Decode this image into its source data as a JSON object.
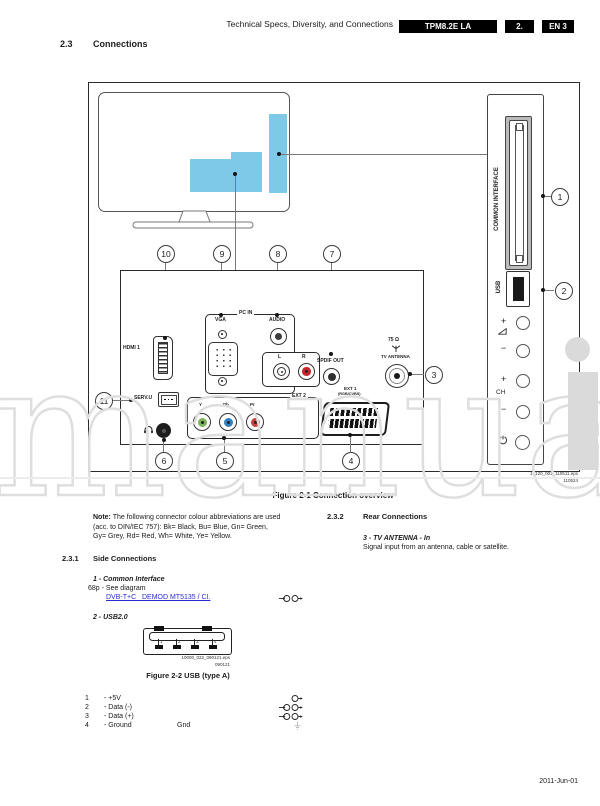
{
  "header": {
    "title": "Technical Specs, Diversity, and Connections",
    "badge_model": "TPM8.2E LA",
    "badge_chapter": "2.",
    "badge_page": "EN 3"
  },
  "section": {
    "number": "2.3",
    "title": "Connections"
  },
  "fig1": {
    "caption": "Figure 2-1 Connection overview",
    "eps_ref": "19120_001_110511.eps",
    "eps_date": "110524",
    "callouts": {
      "n1": "1",
      "n2": "2",
      "n3": "3",
      "n4": "4",
      "n5": "5",
      "n6": "6",
      "n7": "7",
      "n8": "8",
      "n9": "9",
      "n10": "10",
      "n11": "11"
    },
    "labels": {
      "common_interface": "COMMON INTERFACE",
      "usb": "USB",
      "hdmi": "HDMI 1",
      "pc_in": "PC IN",
      "vga": "VGA",
      "audio": "AUDIO",
      "left": "L",
      "right": "R",
      "spdif": "SPDIF OUT",
      "ohm": "75 Ω",
      "tv_antenna": "TV ANTENNA",
      "serv": "SERV.U",
      "ext2": "EXT 2",
      "y": "Y",
      "pb": "Pb",
      "pr": "Pr",
      "ext1": "EXT 1",
      "ext1_sub": "(RGB/CVBS)",
      "plus": "+",
      "minus": "−",
      "ch": "CH"
    }
  },
  "note": {
    "label": "Note:",
    "text1": " The following connector colour abbreviations are used",
    "text2": "(acc. to DIN/IEC 757): Bk= Black, Bu= Blue, Gn= Green,",
    "text3": "Gy= Grey, Rd= Red, Wh= White, Ye= Yellow."
  },
  "sec232": {
    "number": "2.3.2",
    "title": "Rear Connections",
    "item_title": "3 - TV ANTENNA - In",
    "item_text": "Signal input from an antenna, cable or satellite."
  },
  "sec231": {
    "number": "2.3.1",
    "title": "Side Connections",
    "item1_title": "1 - Common Interface",
    "item1_text": "68p - See diagram",
    "item1_link": "DVB-T+C_ DEMOD MT5135 / CI.",
    "item2_title": "2 - USB2.0"
  },
  "fig2": {
    "caption": "Figure 2-2  USB (type A)",
    "eps_ref": "10000_022_090121.eps",
    "eps_date": "090121",
    "pin_labels": [
      "1",
      "2",
      "3",
      "4"
    ]
  },
  "pin_list": [
    {
      "num": "1",
      "desc": "- +5V",
      "extra": ""
    },
    {
      "num": "2",
      "desc": "- Data (-)",
      "extra": ""
    },
    {
      "num": "3",
      "desc": "- Data (+)",
      "extra": ""
    },
    {
      "num": "4",
      "desc": "- Ground",
      "extra": "Gnd"
    }
  ],
  "footer": {
    "date": "2011-Jun-01"
  },
  "watermark": {
    "text": "manua"
  }
}
